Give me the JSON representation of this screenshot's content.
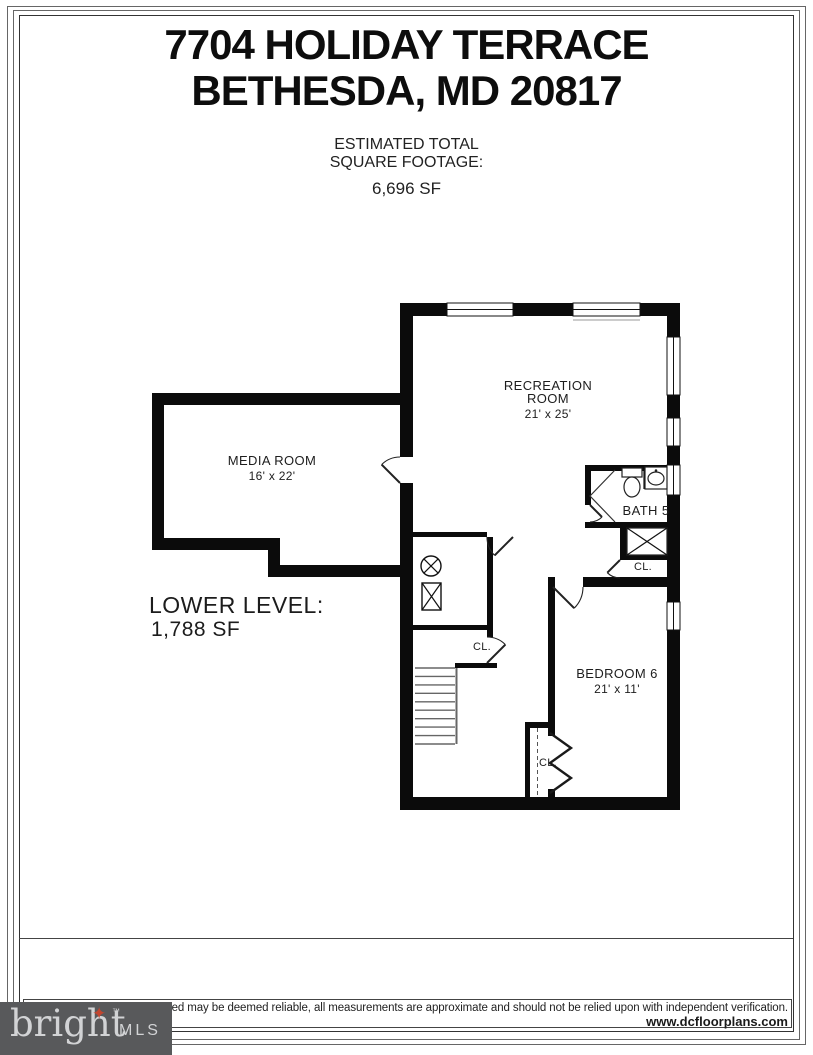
{
  "title": {
    "line1": "7704 HOLIDAY TERRACE",
    "line2": "BETHESDA, MD 20817"
  },
  "subtitle": {
    "line1": "ESTIMATED TOTAL",
    "line2": "SQUARE FOOTAGE:",
    "value": "6,696 SF"
  },
  "level": {
    "name": "LOWER LEVEL:",
    "area": "1,788 SF"
  },
  "rooms": {
    "recreation": {
      "name_line1": "RECREATION",
      "name_line2": "ROOM",
      "dims": "21' x 25'"
    },
    "media": {
      "name": "MEDIA ROOM",
      "dims": "16' x 22'"
    },
    "bedroom6": {
      "name": "BEDROOM 6",
      "dims": "21' x 11'"
    },
    "bath5": {
      "name": "BATH 5"
    },
    "closet_hall": "CL.",
    "closet_bath": "CL.",
    "closet_bedroom": "CL."
  },
  "footer": {
    "disclaimer": "cluded may be deemed reliable, all measurements are approximate and should not be relied upon with independent verification.",
    "website": "www.dcfloorplans.com"
  },
  "logo": {
    "brand": "bright",
    "suffix": "MLS",
    "tm": "™",
    "star_icon": "✦"
  },
  "colors": {
    "wall": "#0b0b0b",
    "logo_bg": "#58595b",
    "logo_text": "#d2d3d5",
    "star": "#c2452f"
  }
}
